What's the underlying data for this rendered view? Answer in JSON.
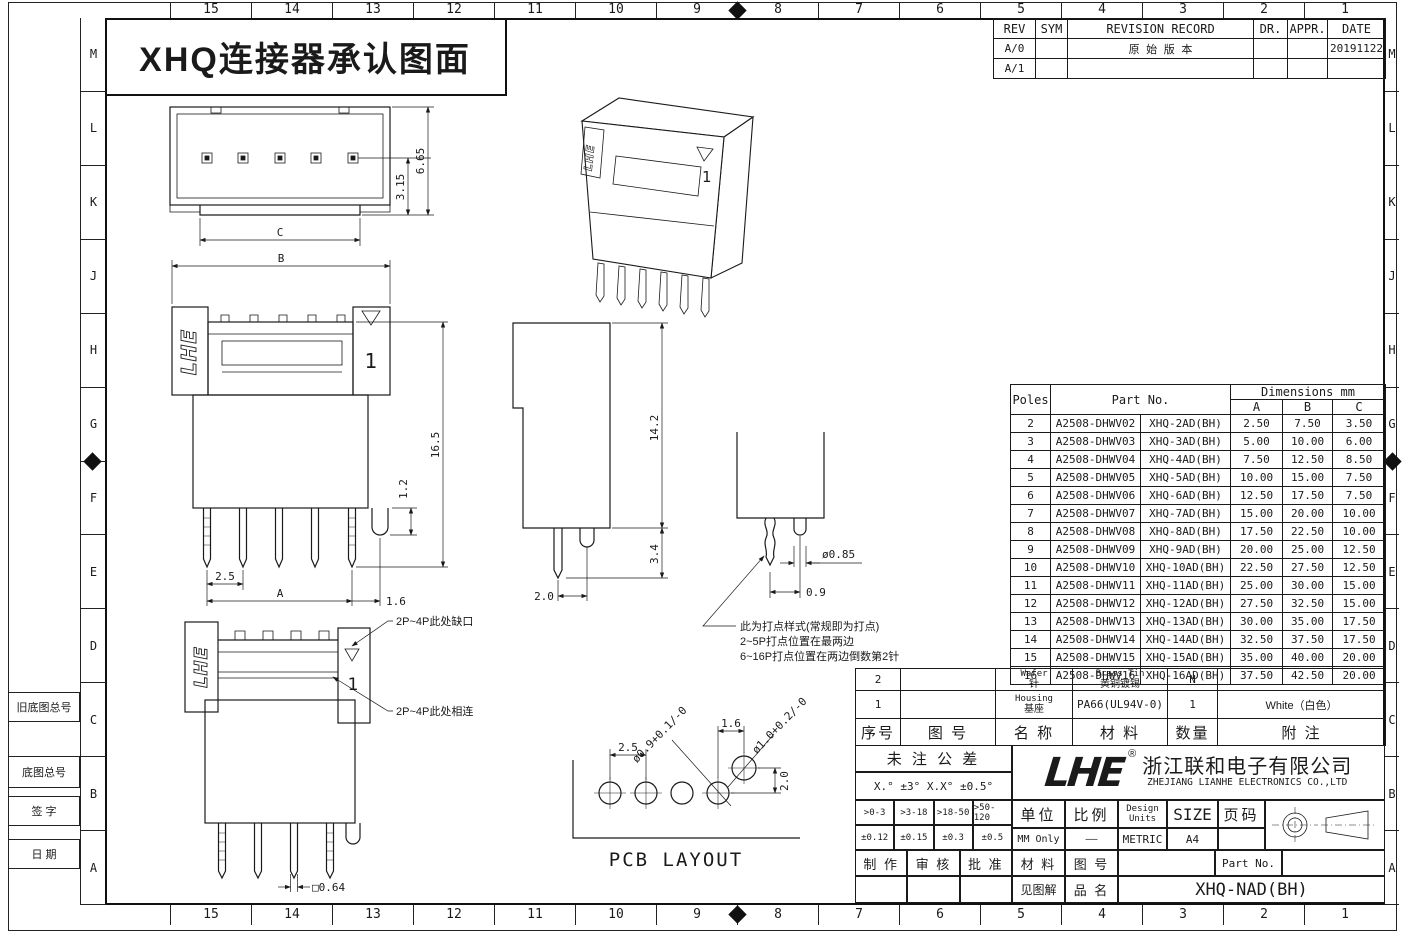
{
  "frame": {
    "title": "XHQ连接器承认图面",
    "col_labels": [
      "15",
      "14",
      "13",
      "12",
      "11",
      "10",
      "9",
      "8",
      "7",
      "6",
      "5",
      "4",
      "3",
      "2",
      "1"
    ],
    "row_labels": [
      "M",
      "L",
      "K",
      "J",
      "H",
      "G",
      "F",
      "E",
      "D",
      "C",
      "B",
      "A"
    ],
    "margin_boxes": [
      "旧底图总号",
      "底图总号",
      "签 字",
      "日 期"
    ]
  },
  "revision": {
    "headers": [
      "REV",
      "SYM",
      "REVISION RECORD",
      "DR.",
      "APPR.",
      "DATE"
    ],
    "rows": [
      [
        "A/0",
        "",
        "原 始 版 本",
        "",
        "",
        "20191122"
      ],
      [
        "A/1",
        "",
        "",
        "",
        "",
        ""
      ]
    ]
  },
  "parts": {
    "poles_header": "Poles",
    "partno_header": "Part No.",
    "dims_header": "Dimensions mm",
    "dim_cols": [
      "A",
      "B",
      "C"
    ],
    "rows": [
      [
        "2",
        "A2508-DHWV02",
        "XHQ-2AD(BH)",
        "2.50",
        "7.50",
        "3.50"
      ],
      [
        "3",
        "A2508-DHWV03",
        "XHQ-3AD(BH)",
        "5.00",
        "10.00",
        "6.00"
      ],
      [
        "4",
        "A2508-DHWV04",
        "XHQ-4AD(BH)",
        "7.50",
        "12.50",
        "8.50"
      ],
      [
        "5",
        "A2508-DHWV05",
        "XHQ-5AD(BH)",
        "10.00",
        "15.00",
        "7.50"
      ],
      [
        "6",
        "A2508-DHWV06",
        "XHQ-6AD(BH)",
        "12.50",
        "17.50",
        "7.50"
      ],
      [
        "7",
        "A2508-DHWV07",
        "XHQ-7AD(BH)",
        "15.00",
        "20.00",
        "10.00"
      ],
      [
        "8",
        "A2508-DHWV08",
        "XHQ-8AD(BH)",
        "17.50",
        "22.50",
        "10.00"
      ],
      [
        "9",
        "A2508-DHWV09",
        "XHQ-9AD(BH)",
        "20.00",
        "25.00",
        "12.50"
      ],
      [
        "10",
        "A2508-DHWV10",
        "XHQ-10AD(BH)",
        "22.50",
        "27.50",
        "12.50"
      ],
      [
        "11",
        "A2508-DHWV11",
        "XHQ-11AD(BH)",
        "25.00",
        "30.00",
        "15.00"
      ],
      [
        "12",
        "A2508-DHWV12",
        "XHQ-12AD(BH)",
        "27.50",
        "32.50",
        "15.00"
      ],
      [
        "13",
        "A2508-DHWV13",
        "XHQ-13AD(BH)",
        "30.00",
        "35.00",
        "17.50"
      ],
      [
        "14",
        "A2508-DHWV14",
        "XHQ-14AD(BH)",
        "32.50",
        "37.50",
        "17.50"
      ],
      [
        "15",
        "A2508-DHWV15",
        "XHQ-15AD(BH)",
        "35.00",
        "40.00",
        "20.00"
      ],
      [
        "16",
        "A2508-DHWV16",
        "XHQ-16AD(BH)",
        "37.50",
        "42.50",
        "20.00"
      ]
    ]
  },
  "bom": {
    "headers": [
      "序号",
      "图  号",
      "名 称",
      "材  料",
      "数量",
      "附  注"
    ],
    "rows": [
      {
        "no": "2",
        "fig": "",
        "name_en": "Wafer",
        "name_cn": "针",
        "mat_en": "Brass Tin",
        "mat_cn": "黄铜镀锡",
        "qty": "N",
        "note": ""
      },
      {
        "no": "1",
        "fig": "",
        "name_en": "Housing",
        "name_cn": "基座",
        "mat_en": "PA66(UL94V-0)",
        "mat_cn": "",
        "qty": "1",
        "note": "White（白色）"
      }
    ]
  },
  "tolerance": {
    "title": "未 注 公 差",
    "angles": "X.° ±3°  X.X° ±0.5°",
    "ranges": [
      ">0-3",
      ">3-18",
      ">18-50",
      ">50-120"
    ],
    "values": [
      "±0.12",
      "±0.15",
      "±0.3",
      "±0.5"
    ],
    "signoff": [
      "制 作",
      "审 核",
      "批 准"
    ]
  },
  "company": {
    "logo": "LHE",
    "reg": "®",
    "cn": "浙江联和电子有限公司",
    "en": "ZHEJIANG LIANHE ELECTRONICS CO.,LTD"
  },
  "info": {
    "unit_label": "单位",
    "unit_value": "MM Only",
    "scale_label": "比例",
    "scale_value": "——",
    "design_label": "Design",
    "units_label": "Units",
    "design_value": "METRIC",
    "size_label": "SIZE",
    "size_value": "A4",
    "page_label": "页码",
    "page_value": "",
    "material_label": "材 料",
    "material_value": "见图解",
    "fig_label": "图 号",
    "partno_label": "Part No.",
    "partno_value": "",
    "product_label": "品 名",
    "product_value": "XHQ-NAD(BH)"
  },
  "drawings": {
    "top_view": {
      "h": "6.65",
      "pin": "3.15",
      "c": "C"
    },
    "front_view": {
      "b": "B",
      "total": "16.5",
      "peg": "1.2",
      "pitch": "2.5",
      "a": "A",
      "edge": "1.6",
      "pin1": "1",
      "logo": "LHE"
    },
    "side_view": {
      "h": "14.2",
      "pin": "3.4",
      "w": "2.0"
    },
    "detail": {
      "dia": "ø0.85",
      "off": "0.9",
      "note1": "此为打点样式(常规即为打点)",
      "note2": "2~5P打点位置在最两边",
      "note3": "6~16P打点位置在两边倒数第2针"
    },
    "bottom_view": {
      "note_notch": "2P~4P此处缺口",
      "note_join": "2P~4P此处相连",
      "pin": "□0.64",
      "pin1": "1",
      "logo": "LHE"
    },
    "pcb": {
      "title": "PCB LAYOUT",
      "pitch": "2.5",
      "gap": "1.6",
      "rise": "2.0",
      "d1": "ø0.9+0.1/-0",
      "d2": "ø1.0+0.2/-0"
    }
  }
}
